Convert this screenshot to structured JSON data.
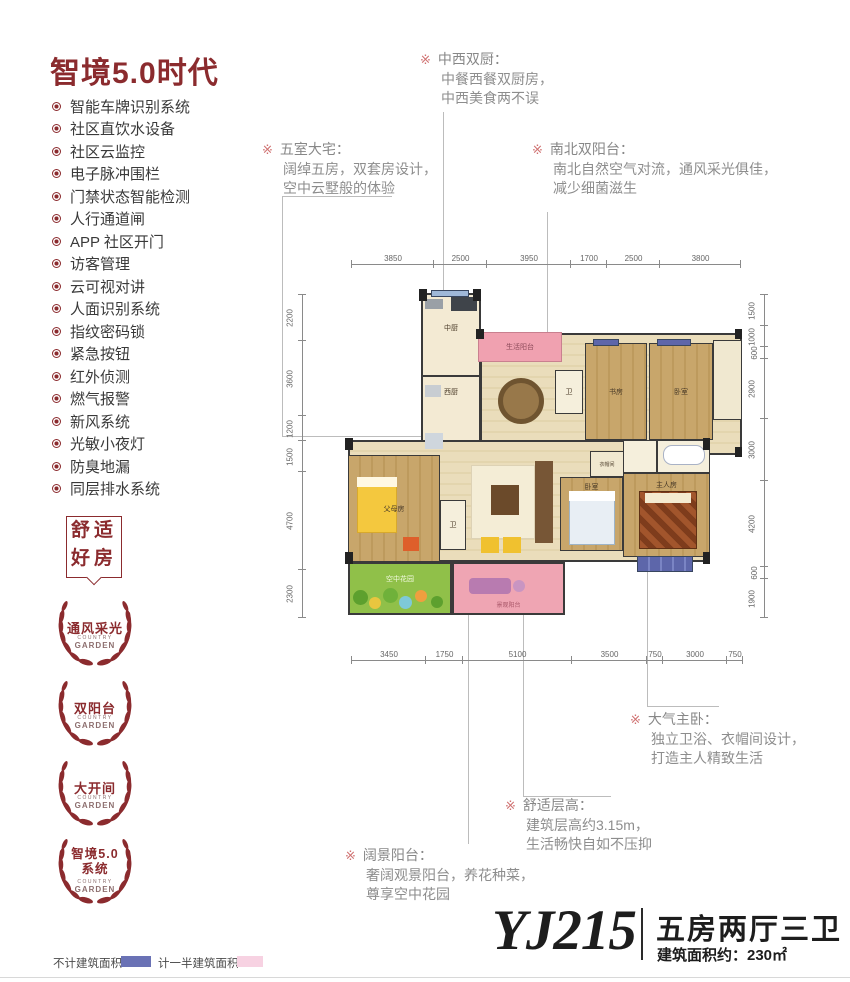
{
  "ui": {
    "marker": "※"
  },
  "sidebar": {
    "title": "智境5.0时代",
    "features": [
      "智能车牌识别系统",
      "社区直饮水设备",
      "社区云监控",
      "电子脉冲围栏",
      "门禁状态智能检测",
      "人行通道闸",
      "APP 社区开门",
      "访客管理",
      "云可视对讲",
      "人面识别系统",
      "指纹密码锁",
      "紧急按钮",
      "红外侦测",
      "燃气报警",
      "新风系统",
      "光敏小夜灯",
      "防臭地漏",
      "同层排水系统"
    ],
    "stamp": {
      "line1": "舒适",
      "line2": "好房"
    },
    "wreaths": [
      {
        "line1": "通风采光",
        "line2": "",
        "sub1": "COUNTRY",
        "sub2": "GARDEN"
      },
      {
        "line1": "双阳台",
        "line2": "",
        "sub1": "COUNTRY",
        "sub2": "GARDEN"
      },
      {
        "line1": "大开间",
        "line2": "",
        "sub1": "COUNTRY",
        "sub2": "GARDEN"
      },
      {
        "line1": "智境5.0",
        "line2": "系统",
        "sub1": "COUNTRY",
        "sub2": "GARDEN"
      }
    ]
  },
  "callouts": {
    "dual_kitchen": {
      "title": "中西双厨：",
      "line1": "中餐西餐双厨房，",
      "line2": "中西美食两不误"
    },
    "five_rooms": {
      "title": "五室大宅：",
      "line1": "阔绰五房，双套房设计，",
      "line2": "空中云墅般的体验"
    },
    "dual_balcony": {
      "title": "南北双阳台：",
      "line1": "南北自然空气对流，通风采光俱佳，",
      "line2": "减少细菌滋生"
    },
    "master_bedroom": {
      "title": "大气主卧：",
      "line1": "独立卫浴、衣帽间设计，",
      "line2": "打造主人精致生活"
    },
    "ceiling_height": {
      "title": "舒适层高：",
      "line1": "建筑层高约3.15m，",
      "line2": "生活畅快自如不压抑"
    },
    "view_balcony": {
      "title": "阔景阳台：",
      "line1": "奢阔观景阳台，养花种菜，",
      "line2": "尊享空中花园"
    }
  },
  "floor_plan": {
    "rooms": {
      "kitchen_cn": "中厨",
      "kitchen_west": "西厨",
      "service_balcony": "生活阳台",
      "bath": "卫",
      "study": "书房",
      "bedroom": "卧室",
      "parents_room": "父母房",
      "master_room": "主人房",
      "cloakroom": "衣帽间",
      "sky_garden": "空中花园",
      "view_balcony": "景观阳台"
    },
    "dims_top": [
      "3850",
      "2500",
      "3950",
      "1700",
      "2500",
      "3800"
    ],
    "dims_bottom": [
      "3450",
      "1750",
      "5100",
      "3500",
      "750",
      "3000",
      "750"
    ],
    "dims_left": [
      "2200",
      "3600",
      "1200",
      "1500",
      "4700",
      "2300"
    ],
    "dims_right": [
      "1500",
      "1000",
      "600",
      "2900",
      "3000",
      "4200",
      "600",
      "1900"
    ]
  },
  "legend": {
    "no_area": "不计建筑面积",
    "no_area_color": "#6a72b5",
    "half_area": "计一半建筑面积",
    "half_area_color": "#f7d2e2"
  },
  "title_block": {
    "model": "YJ215",
    "layout": "五房两厅三卫",
    "area": "建筑面积约：230㎡"
  }
}
